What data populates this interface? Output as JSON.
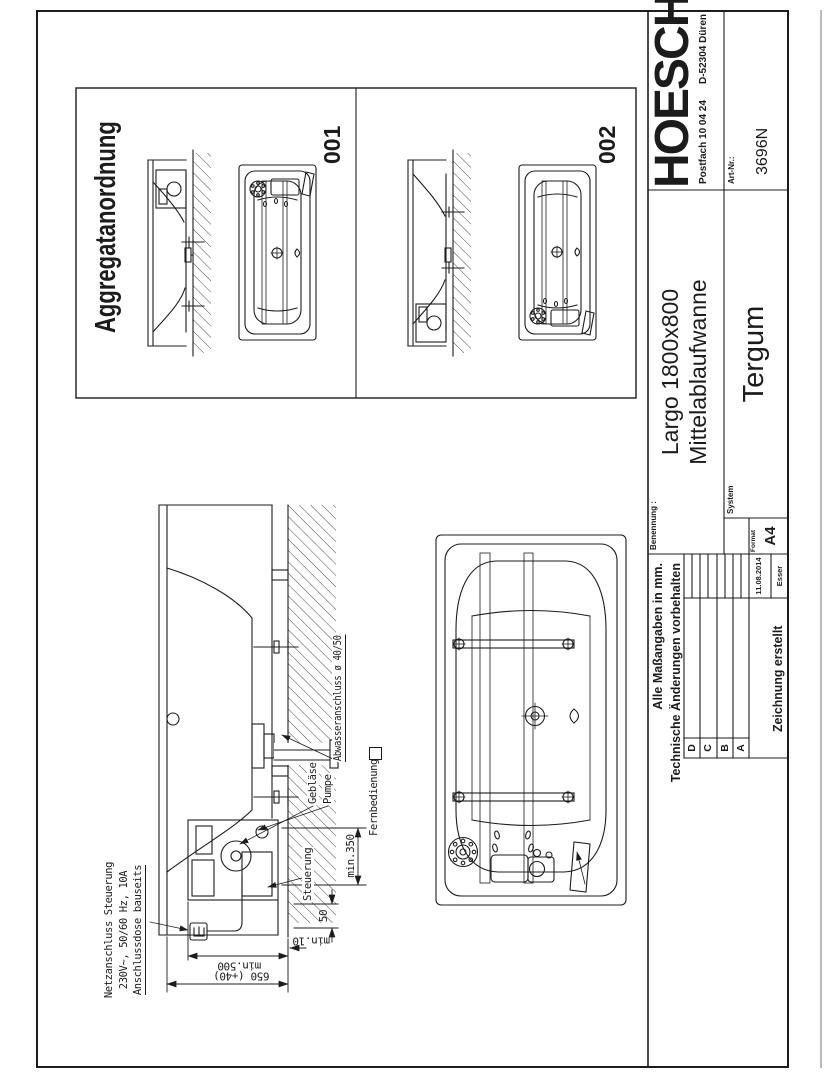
{
  "colors": {
    "ink": "#1c1c1c",
    "paper": "#ffffff"
  },
  "title_block": {
    "brand": "HOESCH",
    "address": "Postfach 10 04 24",
    "city": "D-52304 Düren",
    "art_nr_label": "Art-Nr.:",
    "art_nr": "3696N",
    "benennung_label": "Benennung :",
    "name_line1": "Largo 1800x800",
    "name_line2": "Mittelablaufwanne",
    "system_label": "System",
    "system": "Tergum",
    "note_line1": "Alle Maßangaben in mm.",
    "note_line2": "Technische Änderungen vorbehalten",
    "revision_rows": [
      "D",
      "C",
      "B",
      "A"
    ],
    "created_label": "Zeichnung erstellt",
    "created_date": "11.08.2014",
    "created_by": "Esser",
    "format_label": "Format",
    "format_value": "A4"
  },
  "aggregat": {
    "title": "Aggregatanordnung",
    "view1": "001",
    "view2": "002"
  },
  "annotations": {
    "netz1": "Netzanschluss Steuerung",
    "netz2": "230V~, 50/60 Hz, 10A",
    "netz3": "Anschlussdose bauseits",
    "abwasser": "Abwasseranschluss ø 40/50",
    "geblaese": "Gebläse",
    "pumpe": "Pumpe",
    "steuerung": "Steuerung",
    "fernbedienung": "Fernbedienung"
  },
  "dimensions": {
    "min350": "min.350",
    "d50": "50",
    "min500": "min.500",
    "d650": "650 (+40)",
    "min10": "min.10"
  }
}
